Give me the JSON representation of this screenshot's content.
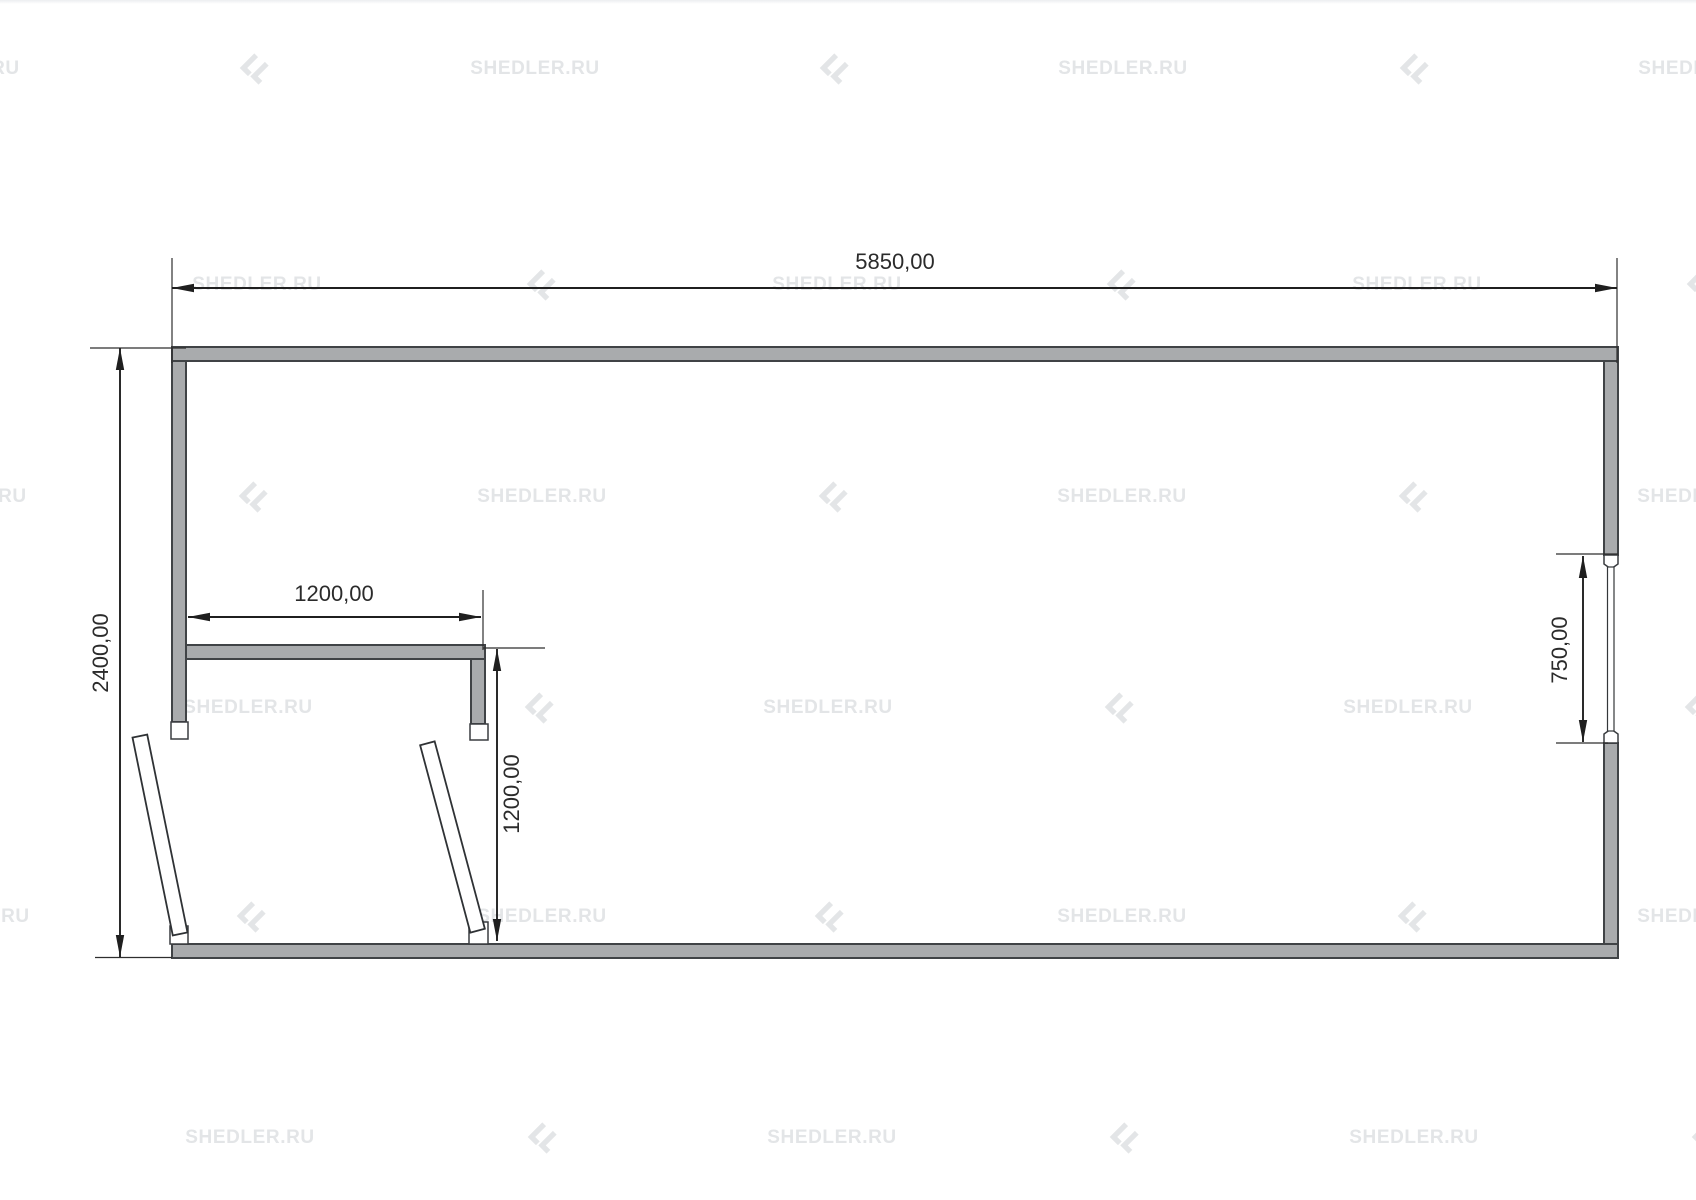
{
  "plan": {
    "dimensions": {
      "overall_width": "5850,00",
      "overall_height": "2400,00",
      "room_width": "1200,00",
      "room_height": "1200,00",
      "window_width": "750,00"
    }
  },
  "watermark": {
    "label": "SHEDLER.RU",
    "items": [
      {
        "t": "text",
        "x": -45,
        "y": 69
      },
      {
        "t": "logo",
        "x": 253,
        "y": 69
      },
      {
        "t": "text",
        "x": 535,
        "y": 69
      },
      {
        "t": "logo",
        "x": 833,
        "y": 69
      },
      {
        "t": "text",
        "x": 1123,
        "y": 69
      },
      {
        "t": "logo",
        "x": 1413,
        "y": 69
      },
      {
        "t": "text",
        "x": 1703,
        "y": 69
      },
      {
        "t": "text",
        "x": 257,
        "y": 285
      },
      {
        "t": "logo",
        "x": 540,
        "y": 285
      },
      {
        "t": "text",
        "x": 837,
        "y": 285
      },
      {
        "t": "logo",
        "x": 1120,
        "y": 285
      },
      {
        "t": "text",
        "x": 1417,
        "y": 285
      },
      {
        "t": "logo",
        "x": 1700,
        "y": 285
      },
      {
        "t": "text",
        "x": -38,
        "y": 497
      },
      {
        "t": "logo",
        "x": 252,
        "y": 497
      },
      {
        "t": "text",
        "x": 542,
        "y": 497
      },
      {
        "t": "logo",
        "x": 832,
        "y": 497
      },
      {
        "t": "text",
        "x": 1122,
        "y": 497
      },
      {
        "t": "logo",
        "x": 1412,
        "y": 497
      },
      {
        "t": "text",
        "x": 1702,
        "y": 497
      },
      {
        "t": "text",
        "x": 248,
        "y": 708
      },
      {
        "t": "logo",
        "x": 538,
        "y": 708
      },
      {
        "t": "text",
        "x": 828,
        "y": 708
      },
      {
        "t": "logo",
        "x": 1118,
        "y": 708
      },
      {
        "t": "text",
        "x": 1408,
        "y": 708
      },
      {
        "t": "logo",
        "x": 1698,
        "y": 708
      },
      {
        "t": "text",
        "x": -35,
        "y": 917
      },
      {
        "t": "logo",
        "x": 250,
        "y": 917
      },
      {
        "t": "text",
        "x": 542,
        "y": 917
      },
      {
        "t": "logo",
        "x": 828,
        "y": 917
      },
      {
        "t": "text",
        "x": 1122,
        "y": 917
      },
      {
        "t": "logo",
        "x": 1411,
        "y": 917
      },
      {
        "t": "text",
        "x": 1702,
        "y": 917
      },
      {
        "t": "text",
        "x": 250,
        "y": 1138
      },
      {
        "t": "logo",
        "x": 541,
        "y": 1138
      },
      {
        "t": "text",
        "x": 832,
        "y": 1138
      },
      {
        "t": "logo",
        "x": 1123,
        "y": 1138
      },
      {
        "t": "text",
        "x": 1414,
        "y": 1138
      },
      {
        "t": "logo",
        "x": 1705,
        "y": 1138
      }
    ]
  },
  "colors": {
    "wall_fill": "#a9abad",
    "wall_stroke": "#404346",
    "dim_line": "#1f1f1f",
    "watermark": "#e3e5e7"
  }
}
